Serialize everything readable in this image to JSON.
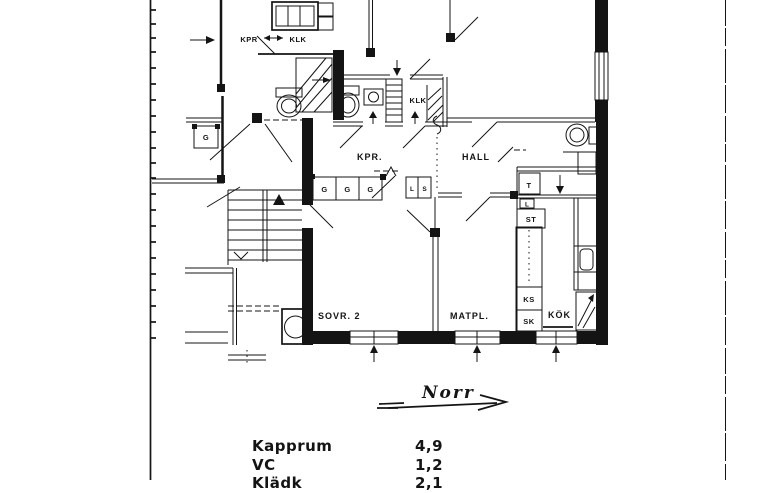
{
  "page": {
    "bg": "#ffffff",
    "ink": "#141414"
  },
  "floor_plan": {
    "rooms": {
      "neighbor_kpr": "KPR",
      "neighbor_klk": "KLK",
      "klk": "KLK",
      "kpr": "KPR.",
      "hall": "HALL",
      "bedroom2": "SOVR. 2",
      "dining": "MATPL.",
      "kitchen": "KÖK"
    },
    "fixtures": {
      "wardrobe": "G",
      "linen": "L",
      "cabinet": "S",
      "drying": "T",
      "linen_small": "L",
      "cleaning": "ST",
      "fridge": "KS",
      "freezer": "SK"
    },
    "north_arrow": {
      "label": "Norr"
    }
  },
  "legend": {
    "rows": [
      {
        "name": "Kapprum",
        "area": "4,9"
      },
      {
        "name": "VC",
        "area": "1,2"
      },
      {
        "name": "Klädk",
        "area": "2,1"
      }
    ]
  }
}
